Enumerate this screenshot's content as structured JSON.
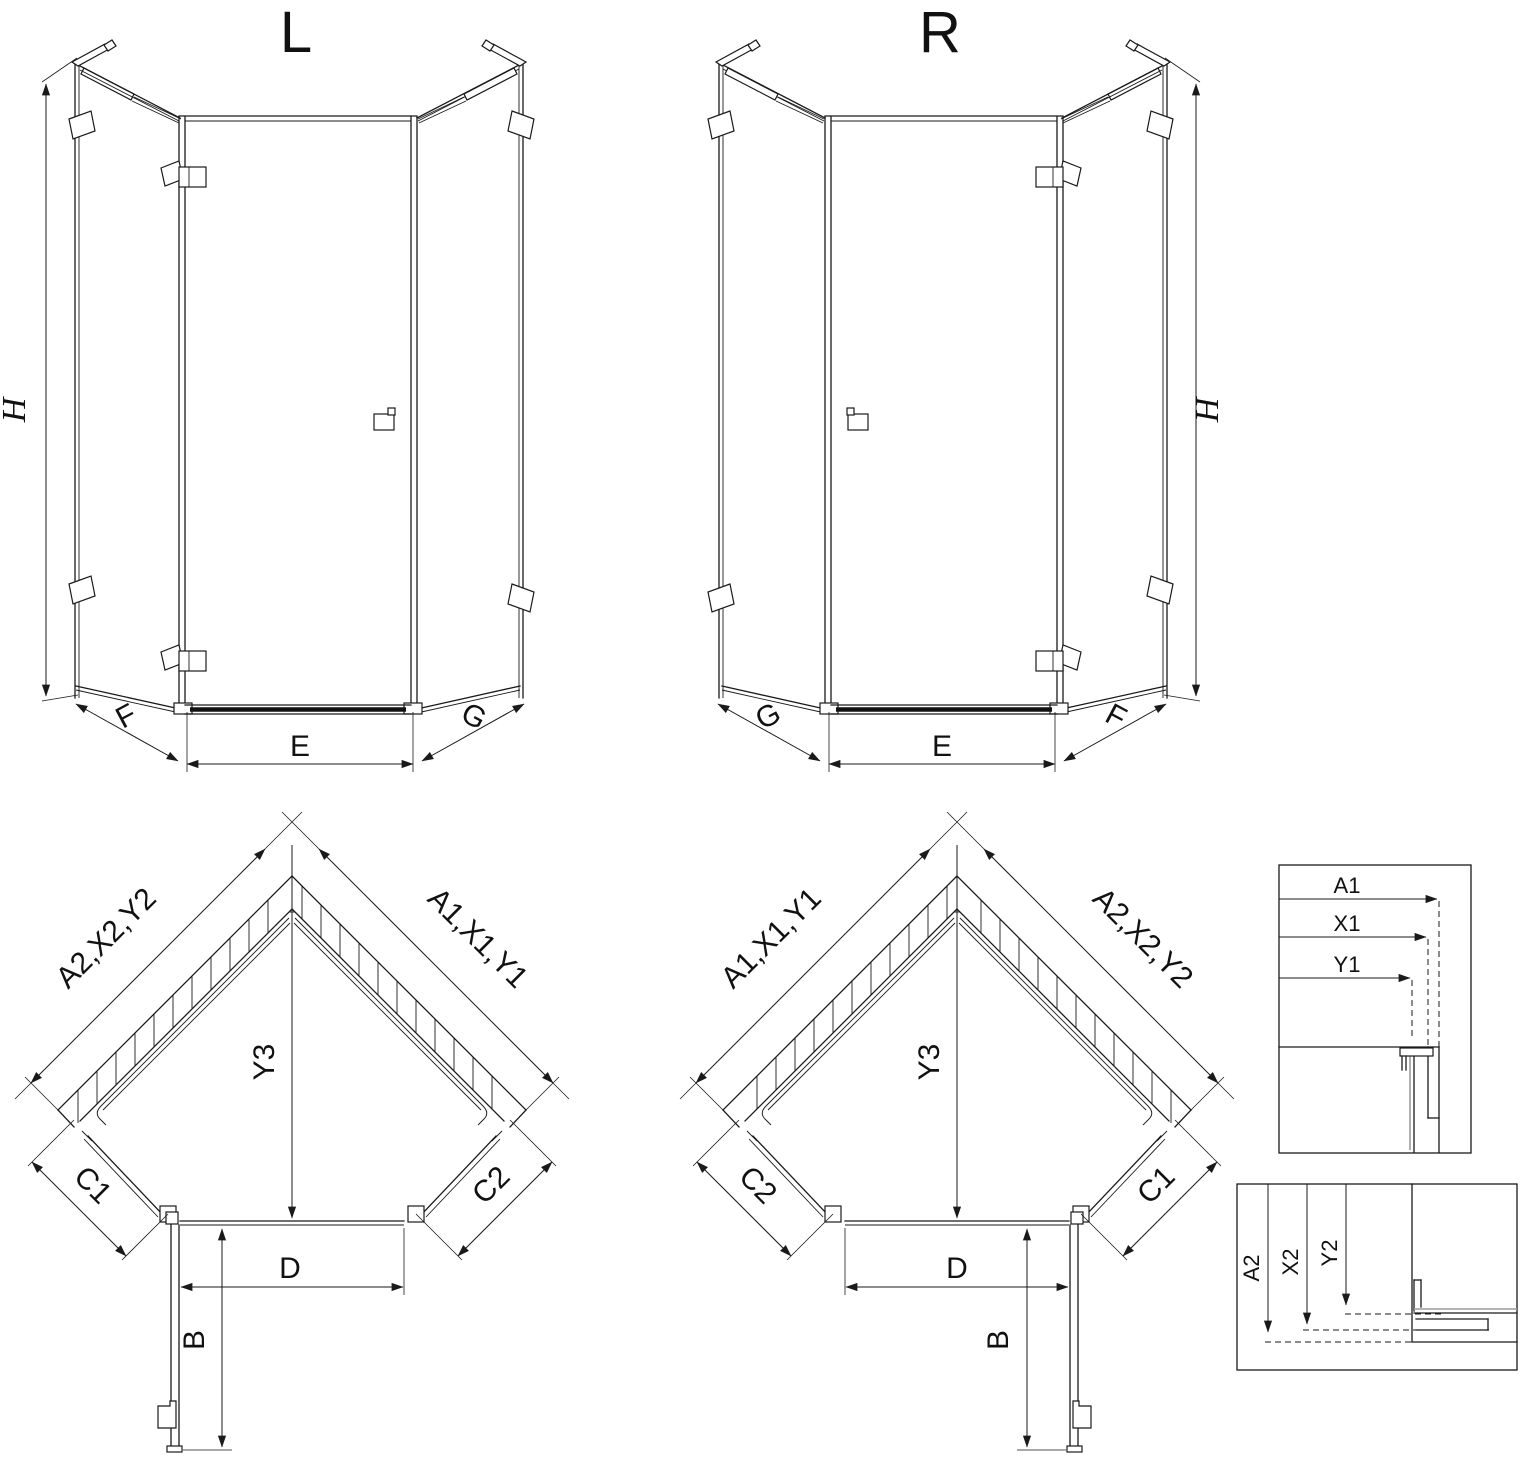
{
  "drawing": {
    "type": "shower-enclosure-installation-diagram",
    "iso_left": {
      "title": "L",
      "height_dim": "H",
      "left_panel_dim": "F",
      "door_dim": "E",
      "right_panel_dim": "G"
    },
    "iso_right": {
      "title": "R",
      "height_dim": "H",
      "left_panel_dim": "G",
      "door_dim": "E",
      "right_panel_dim": "F"
    },
    "plan_left": {
      "wall_left": "A2,X2,Y2",
      "wall_right": "A1,X1,Y1",
      "diagonal_dim": "Y3",
      "side_left": "C1",
      "side_right": "C2",
      "door_width": "D",
      "door_projection": "B"
    },
    "plan_right": {
      "wall_left": "A1,X1,Y1",
      "wall_right": "A2,X2,Y2",
      "diagonal_dim": "Y3",
      "side_left": "C2",
      "side_right": "C1",
      "door_width": "D",
      "door_projection": "B"
    },
    "detail_top": {
      "a": "A1",
      "x": "X1",
      "y": "Y1"
    },
    "detail_bottom": {
      "a": "A2",
      "x": "X2",
      "y": "Y2"
    },
    "colors": {
      "line": "#1a1a1a",
      "gray": "#9b9b9b",
      "background": "#ffffff"
    }
  }
}
